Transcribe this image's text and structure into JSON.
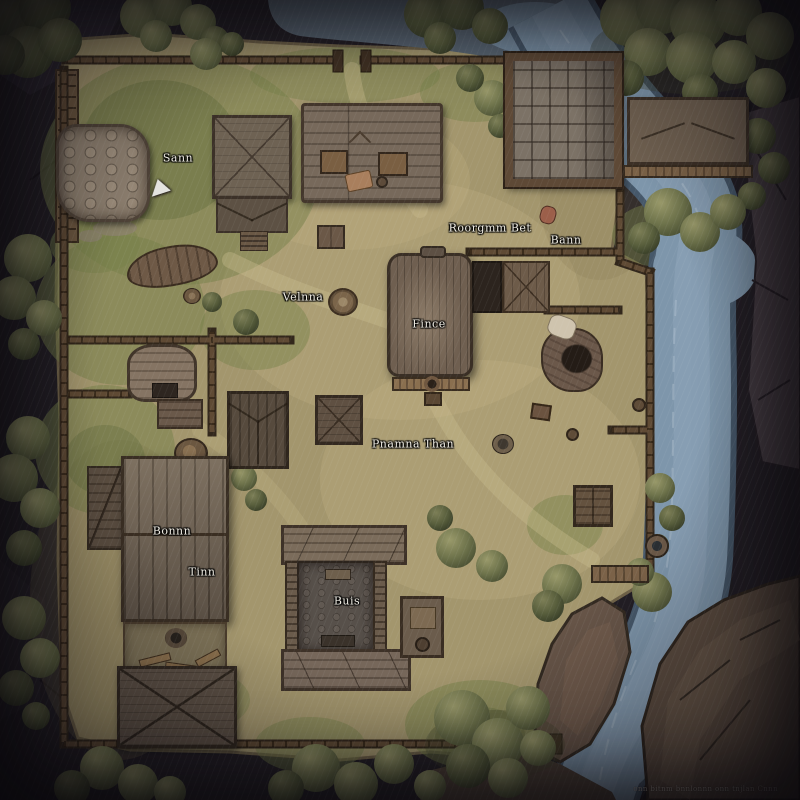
{
  "map": {
    "labels": {
      "sann": "Sann",
      "roorgmm_bet": "Roorgmm Bet",
      "bann": "Bann",
      "velnna": "Velnna",
      "fince": "Fince",
      "pnamna_than": "Pnamna Than",
      "bonnn": "Bonnn",
      "tinn": "Tinn",
      "buis": "Buis"
    },
    "watermark": "onn bitnm bnnlonnn onn tnjlan Cnnn",
    "palette": {
      "border_rock": "#221e24",
      "ground": "#a3966d",
      "grass": "#75804a",
      "water": "#7e96ab",
      "wood_wall": "#5f4a34",
      "roof": "#77695b",
      "label_text": "#f2efe6"
    }
  }
}
